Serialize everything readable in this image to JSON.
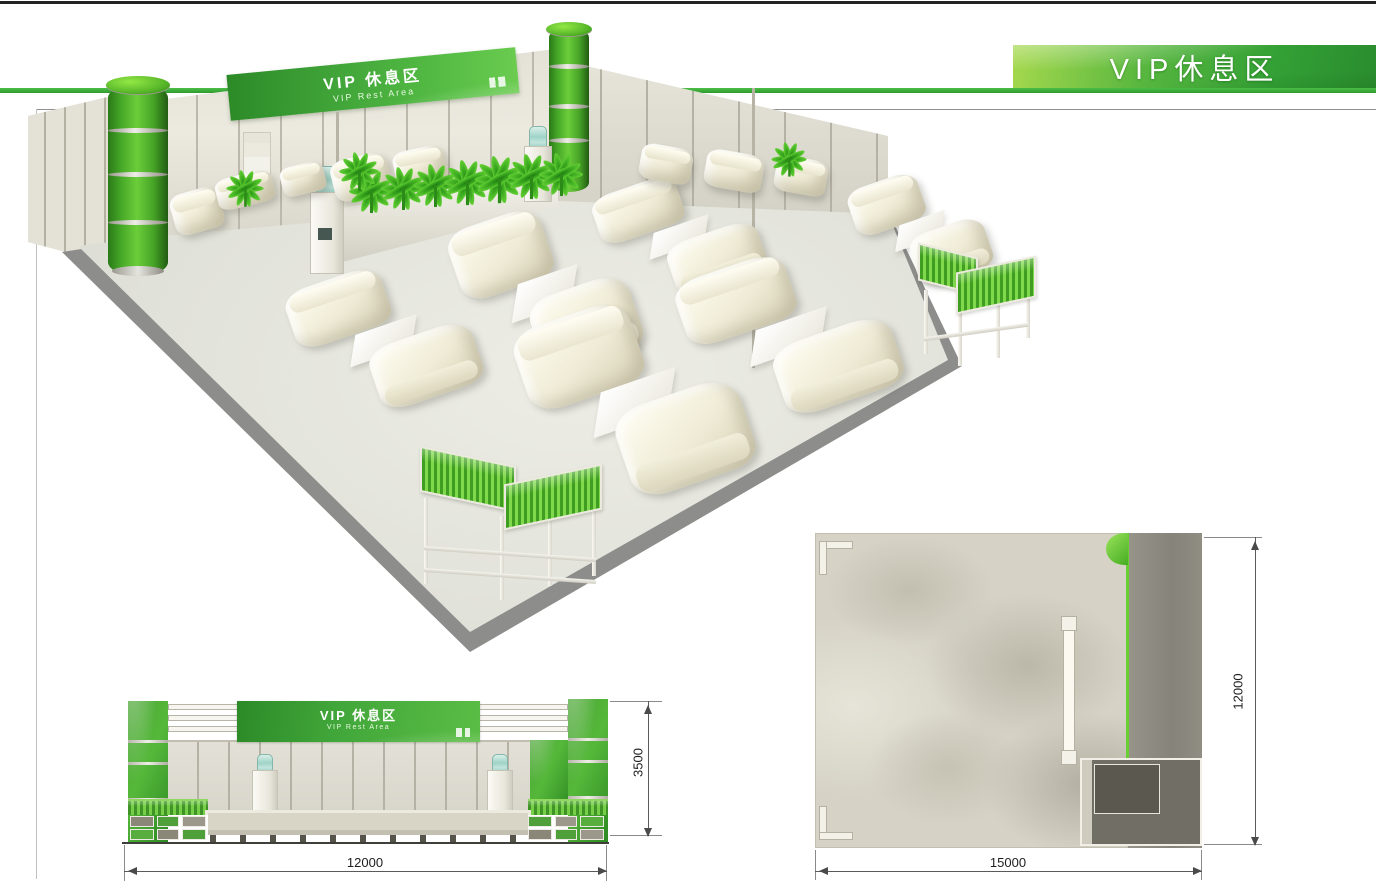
{
  "header": {
    "banner_title": "VIP休息区"
  },
  "scene3d": {
    "sign_title": "VIP 休息区",
    "sign_subtitle": "VIP Rest Area"
  },
  "elevation": {
    "sign_title": "VIP 休息区",
    "sign_subtitle": "VIP Rest Area",
    "dim_width": "12000",
    "dim_height": "3500"
  },
  "plan": {
    "dim_width": "15000",
    "dim_height": "12000"
  },
  "colors": {
    "accent_green": "#3aaf3a",
    "banner_green_light": "#8cc63f",
    "banner_green_dark": "#2e9032",
    "sofa_cream": "#f2efdd",
    "floor_gray": "#dcddd4",
    "plan_floor": "#d6d3c6",
    "plan_strip": "#8f8d83"
  }
}
